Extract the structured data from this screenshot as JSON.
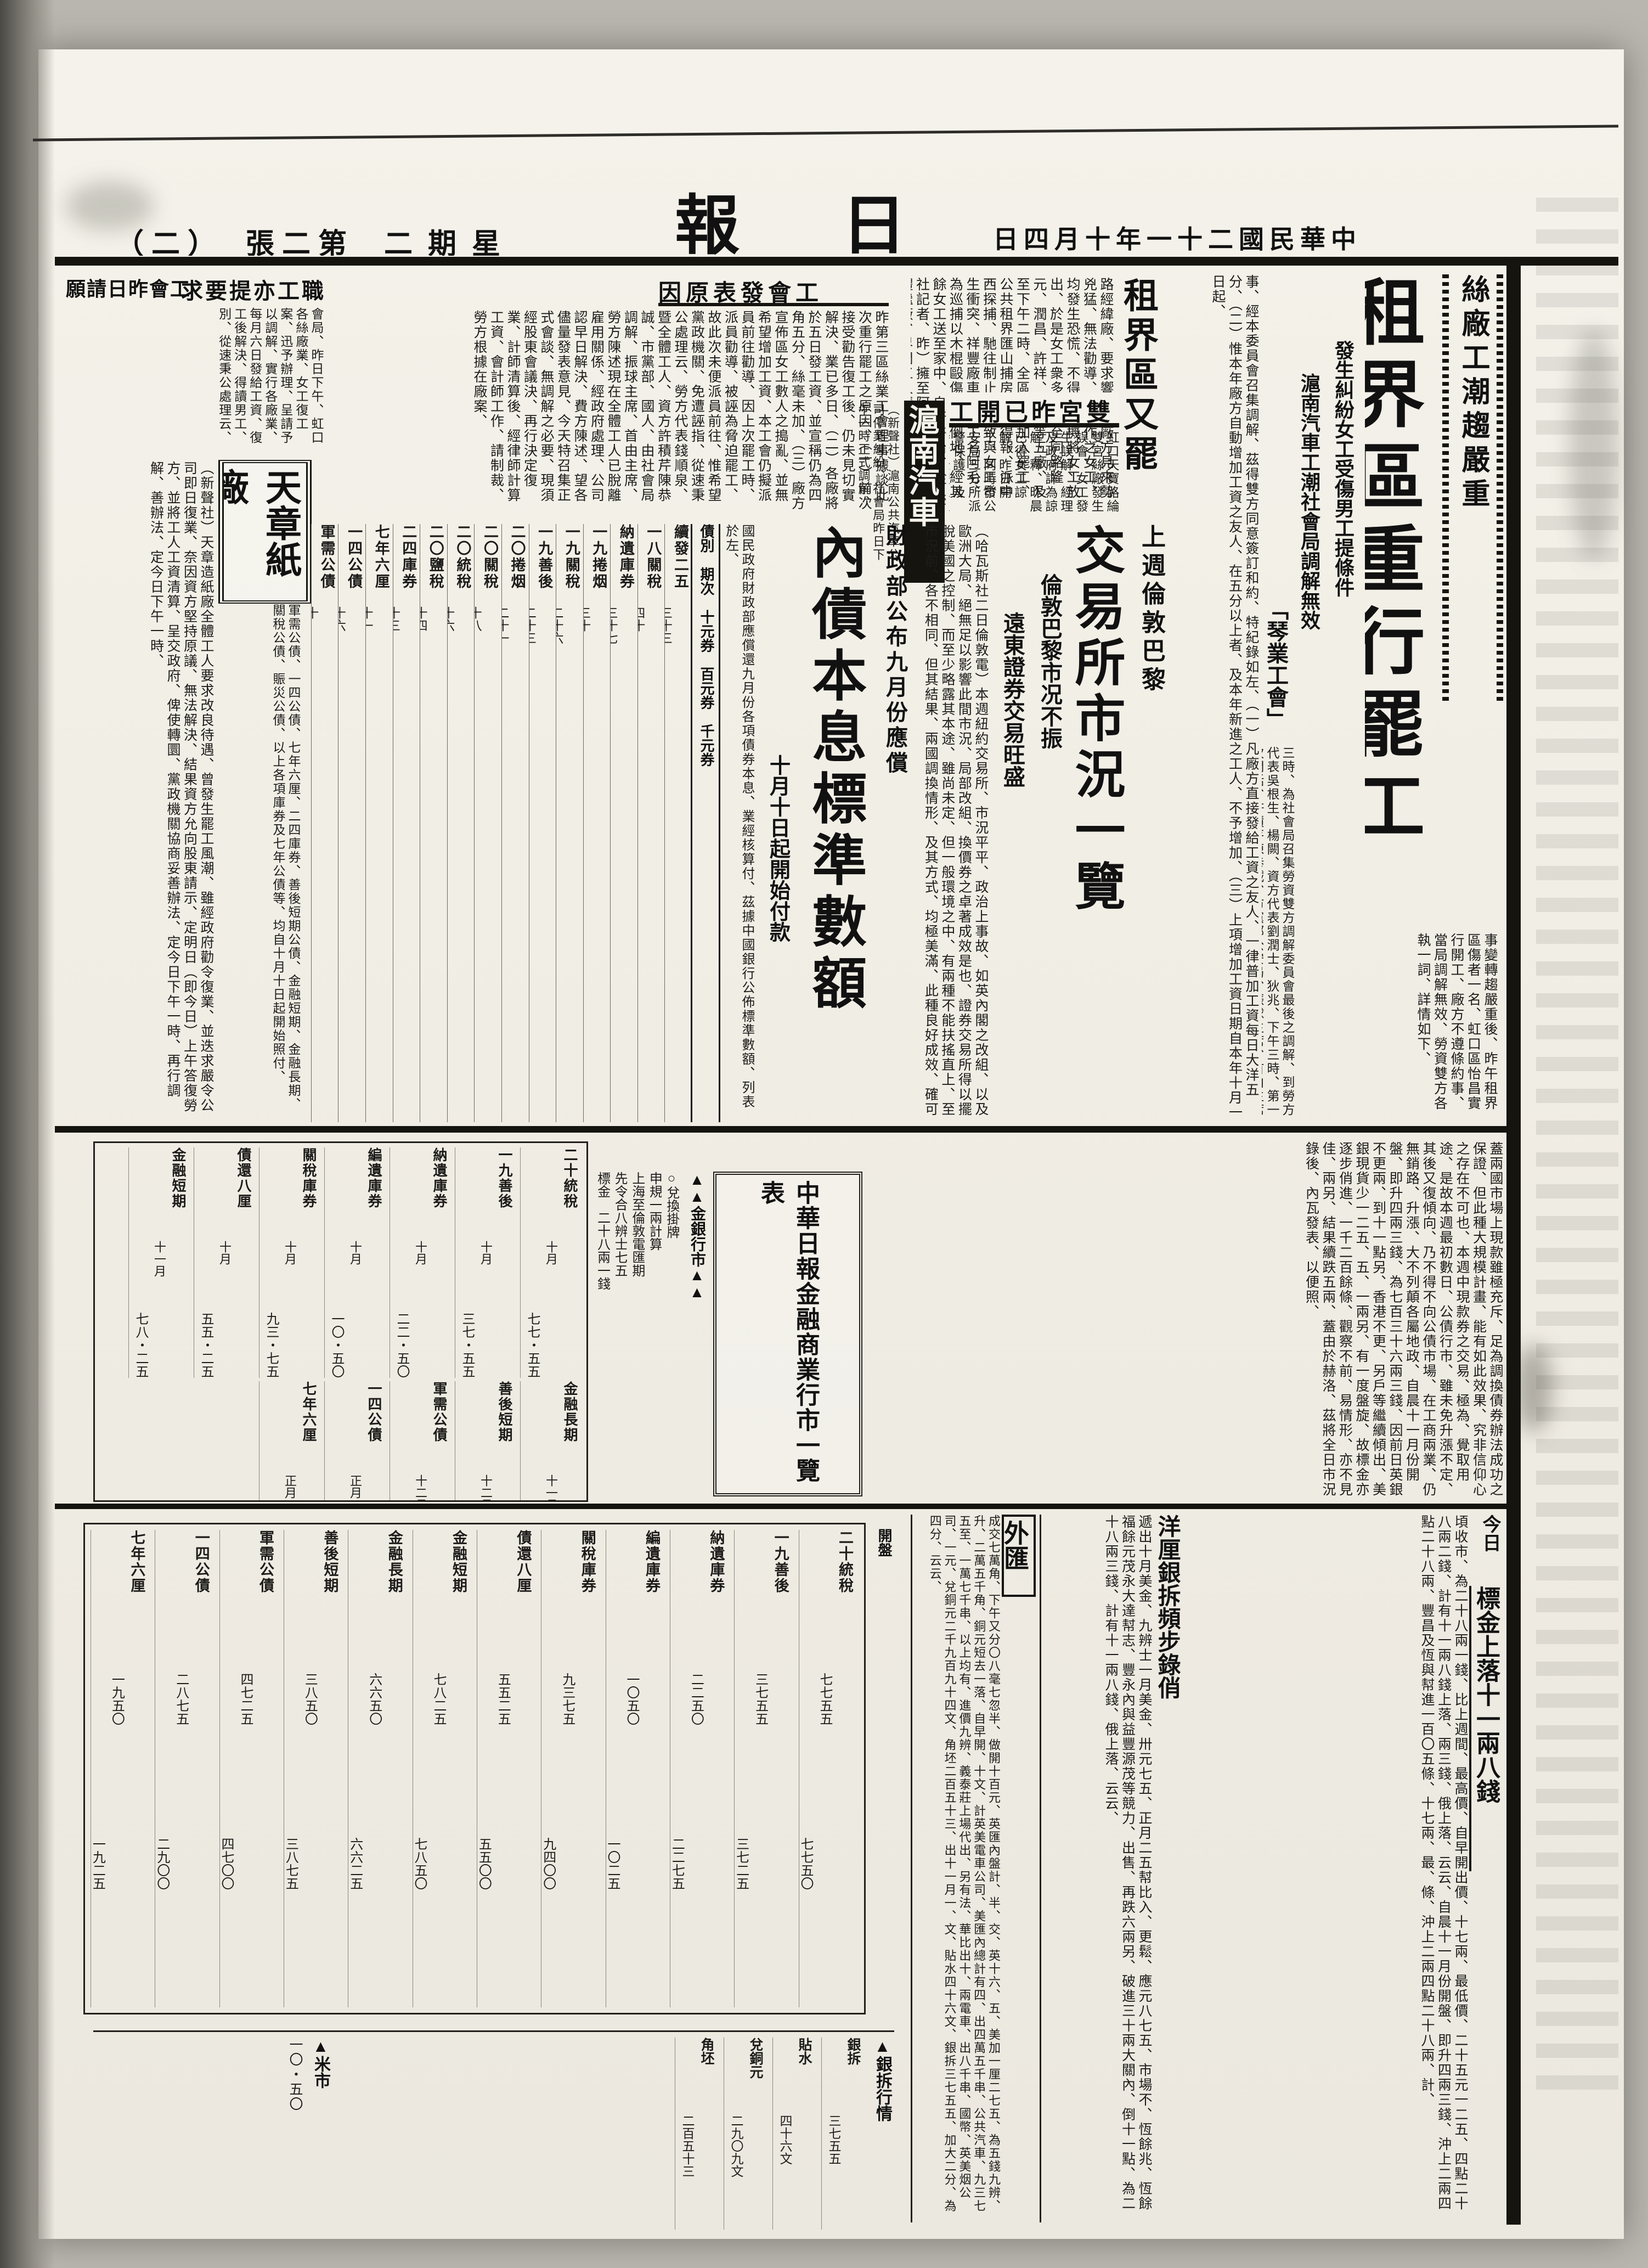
{
  "masthead": {
    "title": "中華日報",
    "title_display": "報　日　華　中",
    "date": "中華民國二十一年十月四日",
    "date_display": "日四月十年一十二國民華中",
    "weekday": "星期二",
    "weekday_display": "二期星",
    "edition": "第二張",
    "edition_display": "（二）　張二第"
  },
  "lead": {
    "kicker": "絲廠工潮趨嚴重",
    "headline": "租界區重行罷工",
    "deck1": "發生糾紛女工受傷男工提條件",
    "deck2": "滬南汽車工潮社會局調解無效",
    "body1": "事變轉趨嚴重後、昨午租界區傷者一名、虹口區怡昌實行開工、廠方不遵條約事、當局調解無效、勞資雙方各執一詞、詳情如下、",
    "union_head": "「琴業工會」",
    "union_body": "事、經本委員會召集調解、茲得雙方同意簽訂和約、特紀錄如左、（一）凡廠方直接發給工資之友人、一律普加工資每日大洋五分、（二）惟本年廠方自動增加工資之友人、在五分以上者、及本年新進之工人、不予增加、（三）上項增加工資日期自本年十月一日起、",
    "meeting_body": "三時、為社會局召集勞資雙方調解委員會最後之調解、到勞方代表吳根生、楊闕、資方代表劉潤士、狄兆、下午三時、第一次問話、許積芹陳恭誠、市黨部公安局、振球主席、首由主席任王先青、國人、由社會局調解、雙方同意簽訂筆錄如下、議當事者、為工資糾紛、如儀、決議案如下、（甲）製辦之、價略、公推江香才主席、開會、經長時間之討論、始得分所派武裝警士維護秩序、"
  },
  "articles": [
    {
      "headline": "租界區又罷工",
      "body": "路經緯廠、要求響應、廠方見來勢兇猛、無法勸導、而工作之女工、均發生恐慌、不得已停機將女工放出、於是女工衆多、擁至同路隆元、潤昌、許祥、祥豐等五廠、及至下午二時、全區完全加入罷工、公共租界匯山捕房首先得報、派中西探捕、馳往制止、以致與女工發生衝突、祥豐廠車間女工名阿毛、為巡捕以木棍毆傷頭部倒地、經其餘女工送至家中、自行醫治、（新聲社記者、昨）擁至阿拉白司脫路全體繼廠、界開工人請求秉公調解、常接受、"
    },
    {
      "headline": "雙宮昨已開工",
      "display": "工開已昨宮雙",
      "body": "虹口天寶路綸雙宮絲廠發生誤會、女工發生誤解、經理及政府詳為諒解、釋、昨晨已得女工諒解、昨日開工、同時市公安局三分所派警保護、及時、全體工人均進廠、秩序甚佳、"
    },
    {
      "headline": "滬南汽車",
      "body": "（新聲社）滬南公共汽車公司停業糾紛、社會局昨日下午一時正式調解、"
    },
    {
      "headline": "工會發表原因",
      "display": "因原表發會工",
      "body": "昨第三區絲業工會理事據談此次重行罷工之原因、（一）前次接受勸告復工後、仍未見切實解決、業已多日、（二）各廠將於五日發工資、並宣稱仍為四角五分、絲毫未加、（三）廠方宣佈區女工數人之搗亂、並無希望增加工資、本工會仍擬派員前往勸導、因上次罷工時、派員勸導、被誣為脅迫罷工、故此次未便派員前往、惟希望黨政機關、免遭誣指、從速秉公處理云、勞方代表錢順泉、暨全體工人、資方許積芹陳恭誠、市黨部、國人、由社會局調解、振球主席、首由主席、勞方陳述現在全體工人已脫離雇用關係、經政府處理、公司認早日解決、費方陳述、望各儘量發表意見、今天特召集正式會談、無調解之必要、現須經股東會議決、再行決定復業、計師清算後、經律師計算工資、會計師工作、請制裁、勞方根據在廠案、"
    },
    {
      "headline": "職工亦提要求",
      "display": "求要提亦工職",
      "headline2": "工會昨日請願",
      "display2": "願請日昨會工",
      "body": "會局、昨日下午、虹口各絲廠業、女工復工案、迅予辦理、呈請予以調解、實行各廠業、每月六日發給工資、復工後解決、得讀男工、別、從速秉公處理云、"
    },
    {
      "headline": "天章紙廠",
      "body": "（新聲社）天章造紙廠全體工人要求改良待遇、曾發生罷工風潮、雖經政府勸令復業、並迭求嚴令公司即日復業、奈因資方堅持原議、無法解決、結果資方允向股東請示、定明日（即今日）上午答復勞方、並將工人工資清算、呈交政府、俾使轉圜、黨政機關協商妥善辦法、定今日下午一時、再行調解、善辦法、定今日下午一時、"
    }
  ],
  "exchange": {
    "kicker": "上週倫敦巴黎",
    "headline": "交易所市況一覽",
    "deck1": "倫敦巴黎市况不振",
    "deck2": "遠東證券交易旺盛",
    "body1": "（哈瓦斯社二日倫敦電）本週紐約交易所、市況平平、政治上事故、如英內閣之改組、以及歐洲大局、絕無足以影響此間市況、局部改組、換價券之卓著成效是也、證券交易所得以擺脫美國之控制、而至少略露其本途、雖尚未定、但一般環境之中、有兩種不能扶搖直上、至市況前、各不相同、但其結果、兩國調換情形、及其方式、均極美滿、此種良好成效、確可使人、禮歐總理演說之後、人心為之樂觀、略為鬆動、但仍有升漲、例如一八八九年四厘公債、及一九〇七年五厘公債、固能反映現今經濟活動、抑亦足以證明一般人之信任、",
    "body2": "蓋兩國市場上現款雖極充斥、足為調換債券辦法成功之保證、但此種大規模計畫、能有如此效果、究非信仰心之存在不可也、本週中現款券之交易、極為、覺取用途、是故本週最初數日、公債行市、雖未免升漲不定、其後又復傾向、乃不得不向公債市場、在工商兩業、仍無銷路、升漲、大不列顛各屬地政、自晨十一月份開盤、即升四兩三錢、為七百三十六兩三錢、因前日英銀不更兩、到十一點另、香港不更、另戶等繼續傾出、美銀現貨少一二五、五、一兩另、有一度盤旋、故標金亦逐步俏進、一千二百餘條、觀察不前、易情形、亦不見佳、兩另、結果續跌五兩、蓋由於赫洛、茲將全日市況錄後、內瓦發表、以便照、"
  },
  "bond": {
    "kicker": "財政部公布九月份應償",
    "headline": "內債本息標準數額",
    "subhead": "十月十日起開始付款",
    "intro": "國民政府財政部應償還九月份各項債券本息、業經核算付、茲據中國銀行公佈標準數額、列表於左、",
    "col_head": "債別　期次　十元券　百元券　千元券",
    "bonds": [
      {
        "name": "續發二五",
        "period": "三十三",
        "v10": "本一元一角",
        "v100": "本一一元　息一角五分"
      },
      {
        "name": "一八關稅",
        "period": "四十",
        "v10": "息一角　本一元",
        "v100": "息一元　本一一元"
      },
      {
        "name": "納遺庫券",
        "period": "三十七",
        "v10": "息七分",
        "v100": "息七角"
      },
      {
        "name": "一九捲烟",
        "period": "三十",
        "v10": "息二分一角",
        "v100": "息二角一分五"
      },
      {
        "name": "一九關稅",
        "period": "二十六",
        "v10": "本息四分八",
        "v100": "息八角七分"
      },
      {
        "name": "一九善後",
        "period": "二十三",
        "v10": "本息六分四",
        "v100": "息三角六分"
      },
      {
        "name": "二〇捲烟",
        "period": "二十一",
        "v10": "息四分",
        "v100": "息四角二分"
      },
      {
        "name": "二〇關稅",
        "period": "十八",
        "v10": "本四分　息四分",
        "v100": "本四角　息四角四分"
      },
      {
        "name": "二〇統稅",
        "period": "十六",
        "v10": "息五分",
        "v100": "本四角五分"
      },
      {
        "name": "二〇鹽稅",
        "period": "十四",
        "v10": "本息五分",
        "v100": "息一元五角"
      },
      {
        "name": "二四庫券",
        "period": "十三",
        "v10": "息一角",
        "v100": "息一元五角"
      },
      {
        "name": "七年六厘",
        "period": "十一",
        "v10": "息一元五角",
        "v100": "息一一元五角"
      },
      {
        "name": "一四公債",
        "period": "十六",
        "v10": "息一角五分",
        "v100": "息一元五角分"
      },
      {
        "name": "軍需公債",
        "period": "十",
        "v10": "息一角五分",
        "v100": "息一元五角"
      }
    ],
    "other": "軍需公債、一四公債、七年六厘、二四庫券、善後短期公債、金融短期、金融長期、關稅公債、賑災公債、以上各項庫券及七年公債等、均自十月十日起開始照付、"
  },
  "market_table": {
    "title": "中華日報金融商業行市一覽表",
    "gold_header": "▲▲金銀行市▲▲",
    "gold_items": [
      "○兌換掛牌",
      "申規一兩計算",
      "上海至倫敦電匯期",
      "先令合八辨士七五",
      "標金　二十八兩一錢"
    ],
    "rows": [
      {
        "name": "二十統稅",
        "month": "十月",
        "price": "七七・五五"
      },
      {
        "name": "一九善後",
        "month": "十月",
        "price": "三七・五五"
      },
      {
        "name": "納遺庫券",
        "month": "十月",
        "price": "二二・五〇"
      },
      {
        "name": "編遺庫券",
        "month": "十月",
        "price": "一〇・五〇"
      },
      {
        "name": "關稅庫券",
        "month": "十月",
        "price": "九三・七五"
      },
      {
        "name": "債還八厘",
        "month": "十月",
        "price": "五五・二五"
      },
      {
        "name": "金融短期",
        "month": "十一月",
        "price": "七八・二五"
      },
      {
        "name": "金融長期",
        "month": "十一月",
        "price": "六六・五〇"
      },
      {
        "name": "善後短期",
        "month": "十二月",
        "price": "三八・五〇"
      },
      {
        "name": "軍需公債",
        "month": "十二月",
        "price": "四七・二五"
      },
      {
        "name": "一四公債",
        "month": "正月",
        "price": "二八・七五"
      },
      {
        "name": "七年六厘",
        "month": "正月",
        "price": "一九・五〇"
      }
    ]
  },
  "board": {
    "col_open": "開盤",
    "col_close": "收盤",
    "rows": [
      {
        "name": "二十統稅",
        "open": "七七五五",
        "close": "七七五〇"
      },
      {
        "name": "一九善後",
        "open": "三七五五",
        "close": "三七二五"
      },
      {
        "name": "納遺庫券",
        "open": "二二五〇",
        "close": "二二七五"
      },
      {
        "name": "編遺庫券",
        "open": "一〇五〇",
        "close": "一〇二五"
      },
      {
        "name": "關稅庫券",
        "open": "九三七五",
        "close": "九四〇〇"
      },
      {
        "name": "債還八厘",
        "open": "五五二五",
        "close": "五五〇〇"
      },
      {
        "name": "金融短期",
        "open": "七八二五",
        "close": "七八五〇"
      },
      {
        "name": "金融長期",
        "open": "六六五〇",
        "close": "六六二五"
      },
      {
        "name": "善後短期",
        "open": "三八五〇",
        "close": "三八七五"
      },
      {
        "name": "軍需公債",
        "open": "四七二五",
        "close": "四七〇〇"
      },
      {
        "name": "一四公債",
        "open": "二八七五",
        "close": "二九〇〇"
      },
      {
        "name": "七年六厘",
        "open": "一九五〇",
        "close": "一九二五"
      }
    ]
  },
  "finance": {
    "gold_label": "今日",
    "gold_head": "標金上落十一兩八錢",
    "gold_body": "頃收市、為二十八兩一錢、比上週間、最高價、自早開出價、十七兩、最低價、二十五元一二五、四點二十八兩二錢、計有十一兩八錢上落、兩三錢、俄上落、云云、自晨十一月份開盤、即升四兩三錢、沖上二兩四點二十八兩、豐昌及恆與幇進一百〇五條、十七兩、最、條、沖上二兩四點二十八兩、計、",
    "silver_head": "洋厘銀拆頻步錄俏",
    "silver_body": "遞出十月美金、九辨士一月美金、卅元七五、正月二五幇比入、更鬆、應元八七五、市場不、恆餘兆、恆餘福餘元茂永大達幇志、豐永內與益豐源茂等競力、出售、再跌六兩另、破進三十兩大關內、倒十一點、為二十八兩三錢、計有十一兩八錢、俄上落、云云、",
    "fx_head": "外匯",
    "fx_body": "成交七萬角、下午又分〇八毫七忽半、做開十百元、英匯內盤計、半、交、英十六、五、美加一厘二七五、為五錢九辨、升、二萬五千角、銅元短去一落、自早開、十文、計英美電車公司、美匯內總計有四、出四萬五千串、公共汽車、九三七五至、一萬七千串、以上均有、進價九辨、義泰莊上場代出、另有法、華比出十、兩電車、出八千串、國幣、英美烟公司、一元、兌銅元二千九百九十四文、角坯二百五十三、出十一月一、文、貼水四十六文、銀拆三七五五、加大二分、為四分、云云、"
  },
  "side": {
    "bank_header": "▲銀拆行情",
    "rows": [
      {
        "label": "銀拆",
        "value": "三七五五"
      },
      {
        "label": "貼水",
        "value": "四十六文"
      },
      {
        "label": "兌銅元",
        "value": "二九〇九文"
      },
      {
        "label": "角坯",
        "value": "二百五十三"
      }
    ],
    "rice_header": "▲米市",
    "rice_value": "一〇・五〇"
  }
}
